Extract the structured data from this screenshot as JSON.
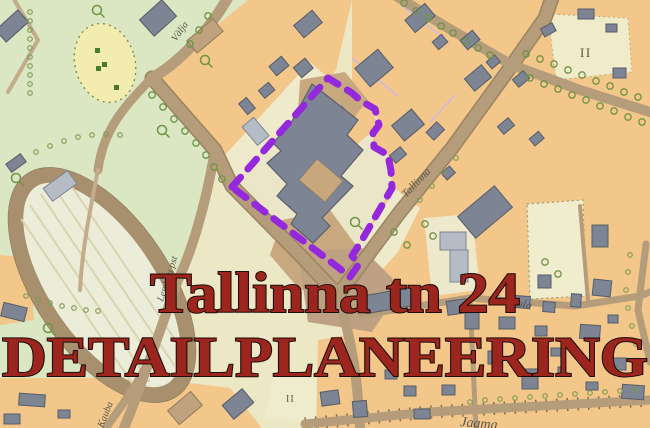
{
  "title": {
    "line1": "Tallinna tn 24",
    "line2": "DETAILPLANEERING"
  },
  "map": {
    "street_labels": [
      {
        "id": "valja",
        "text": "Välja"
      },
      {
        "id": "tallinna",
        "text": "Tallinna"
      },
      {
        "id": "vambola",
        "text": "Vambola"
      },
      {
        "id": "jaama",
        "text": "Jaama"
      },
      {
        "id": "lembitu-pst",
        "text": "Lembitu pst"
      },
      {
        "id": "kauba",
        "text": "Kauba"
      }
    ],
    "area_labels": [
      {
        "id": "storeys-northeast",
        "text": "II"
      },
      {
        "id": "storeys-south",
        "text": "II"
      }
    ],
    "boundary": {
      "purpose": "detail plan area boundary",
      "color": "#9428dd",
      "style": "dashed"
    },
    "palette": {
      "park_green": "#dbe7c2",
      "parcel_orange": "#f3c78a",
      "parcel_cream": "#ece7c4",
      "building_gray": "#7d8494",
      "building_light": "#b6bcc6",
      "road_tan": "#b59c7a",
      "track_brown": "#a8906e",
      "title_red": "#9c251e",
      "title_outline": "#1c0d08",
      "label_gray": "#5b564b"
    }
  }
}
